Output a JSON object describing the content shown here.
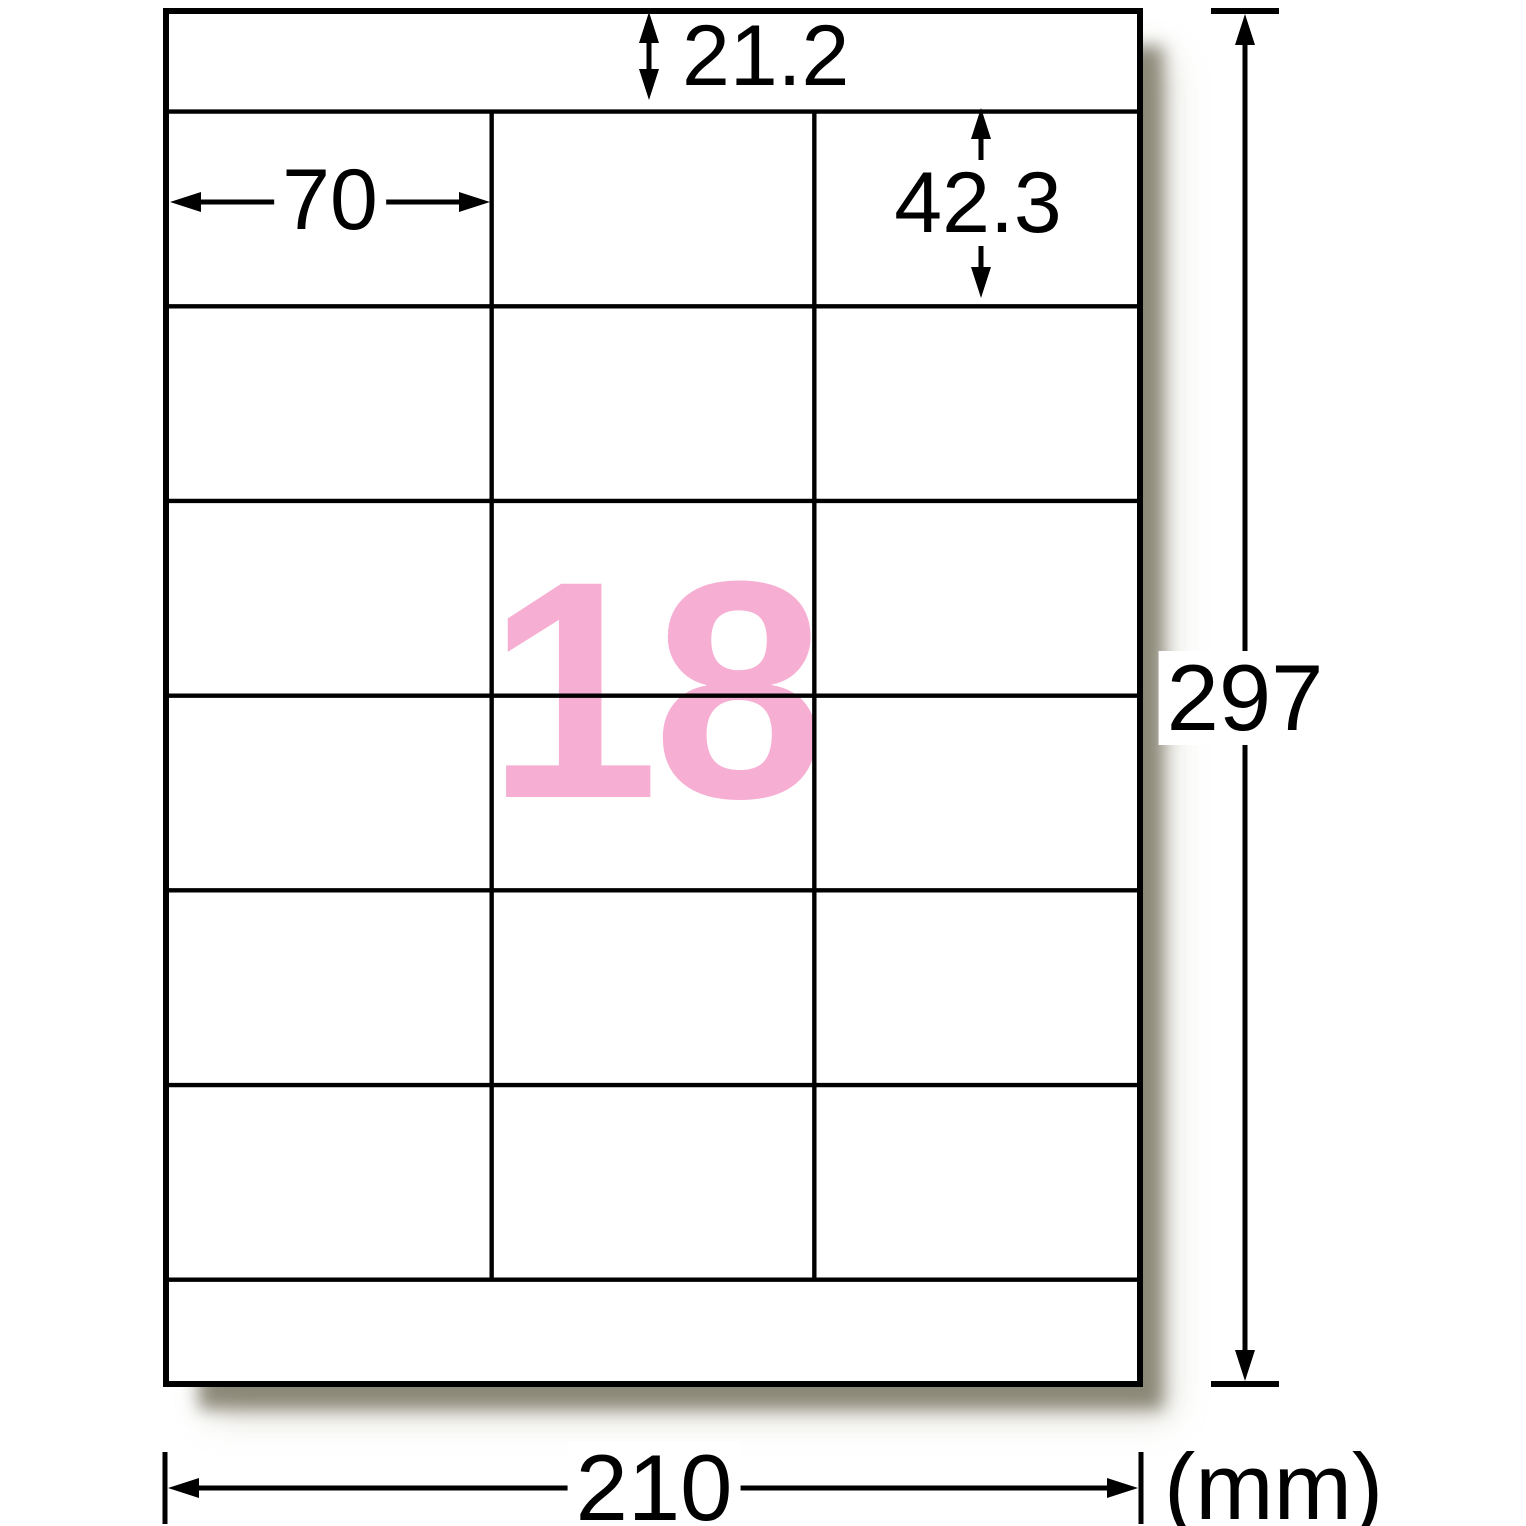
{
  "sheet": {
    "count": "18",
    "count_color": "#f7aed3",
    "rows": 6,
    "columns": 3
  },
  "dims": {
    "top_margin": "21.2",
    "label_width": "70",
    "label_height": "42.3",
    "page_height": "297",
    "page_width": "210",
    "unit": "(mm)"
  }
}
